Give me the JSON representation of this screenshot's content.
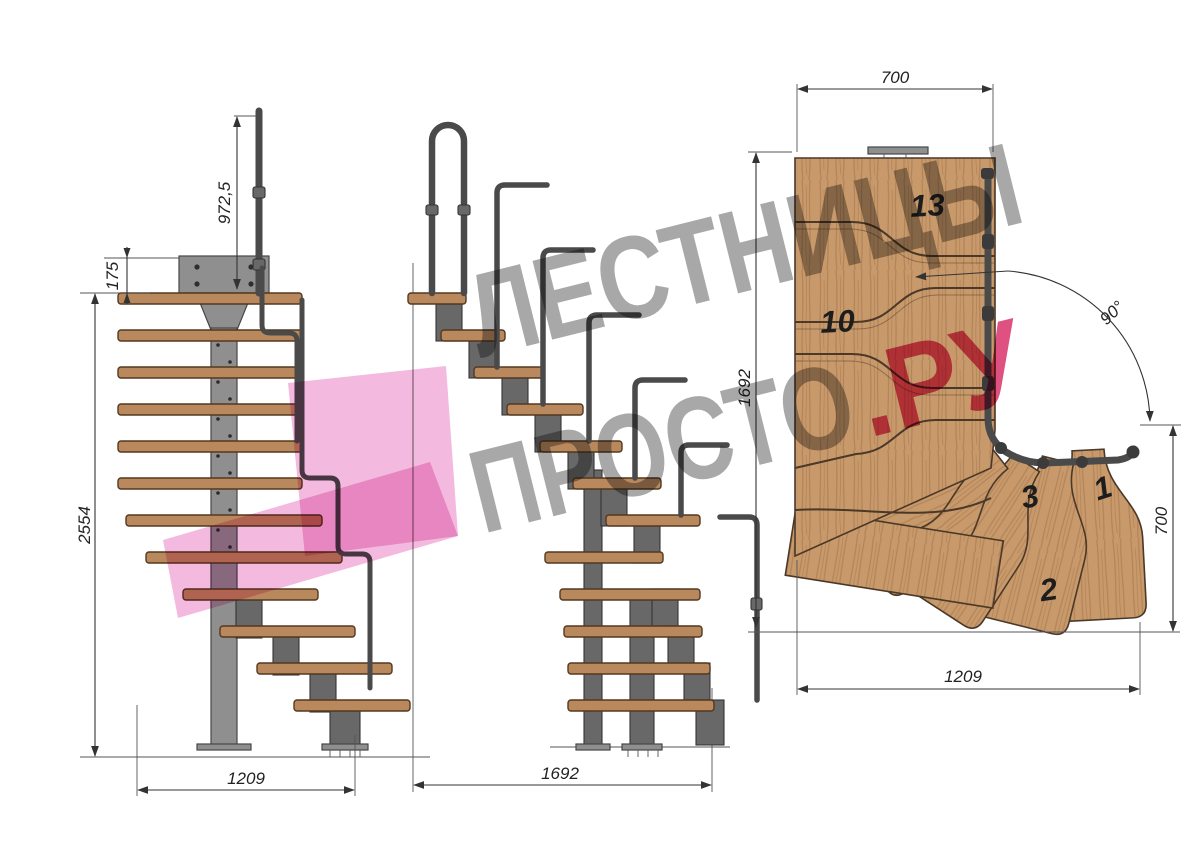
{
  "watermark": {
    "line1": "ЛЕСТНИЦЫ",
    "line2_gray": "ПРОСТО",
    "line2_accent": ".РУ",
    "text_color": "#a8a8a8",
    "accent_color": "#df5180",
    "logo_color": "#f3b9de"
  },
  "side_view": {
    "dim_handrail_height": "972,5",
    "dim_plate_offset": "175",
    "dim_total_height": "2554",
    "dim_run": "1209"
  },
  "front_view": {
    "dim_run": "1692"
  },
  "plan_view": {
    "dim_top_width": "700",
    "dim_left_depth": "1692",
    "dim_angle": "90°",
    "dim_right_depth": "700",
    "dim_bottom_width": "1209",
    "step_labels": {
      "s13": "13",
      "s10": "10",
      "s3": "3",
      "s1": "1",
      "s2": "2"
    }
  },
  "colors": {
    "background": "#ffffff",
    "line": "#3c3c3c",
    "wood_face": "#b9885d",
    "wood_plan_base": "#c89a6b",
    "metal": "#8f8f8f",
    "rail": "#4a4a4a",
    "dim_text": "#222222"
  }
}
